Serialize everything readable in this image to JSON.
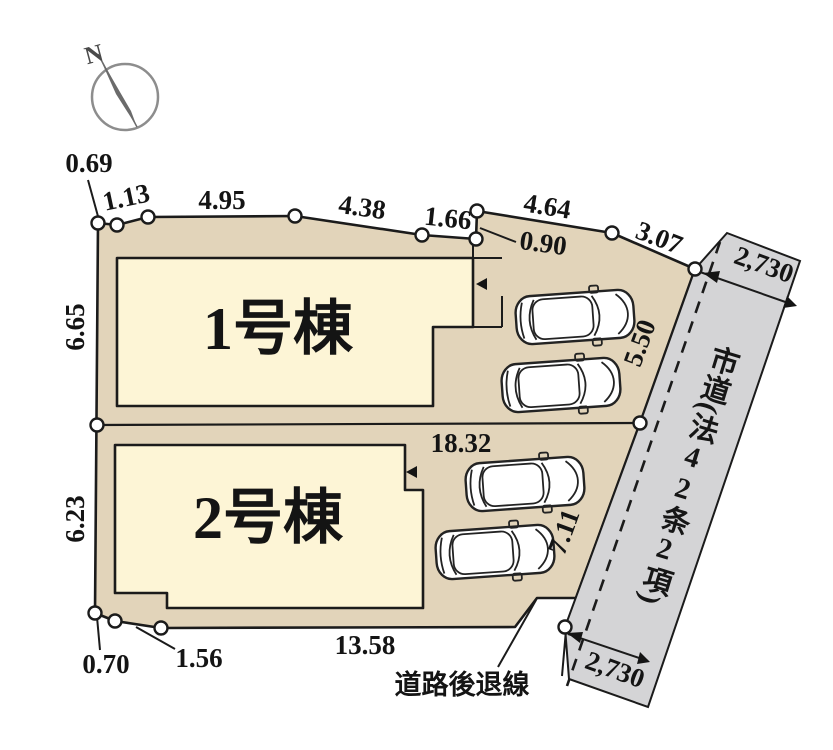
{
  "north_label": "N",
  "buildings": [
    {
      "label": "1号棟"
    },
    {
      "label": "2号棟"
    }
  ],
  "road": {
    "label": "市道(法42条2項)",
    "width_top": "2,730",
    "width_bottom": "2,730"
  },
  "annotations": {
    "setback": "道路後退線"
  },
  "dims": {
    "top1": "0.69",
    "top2": "1.13",
    "top3": "4.95",
    "top4": "4.38",
    "top5": "1.66",
    "top6": "0.90",
    "top7": "4.64",
    "top8": "3.07",
    "left1": "6.65",
    "left2": "6.23",
    "right1": "5.50",
    "right2": "7.11",
    "mid": "18.32",
    "bottom1": "13.58",
    "bottom2": "0.70",
    "bottom3": "1.56"
  },
  "colors": {
    "lot": "#e2d4ba",
    "building": "#fdf5d6",
    "road": "#d4d4d6"
  }
}
